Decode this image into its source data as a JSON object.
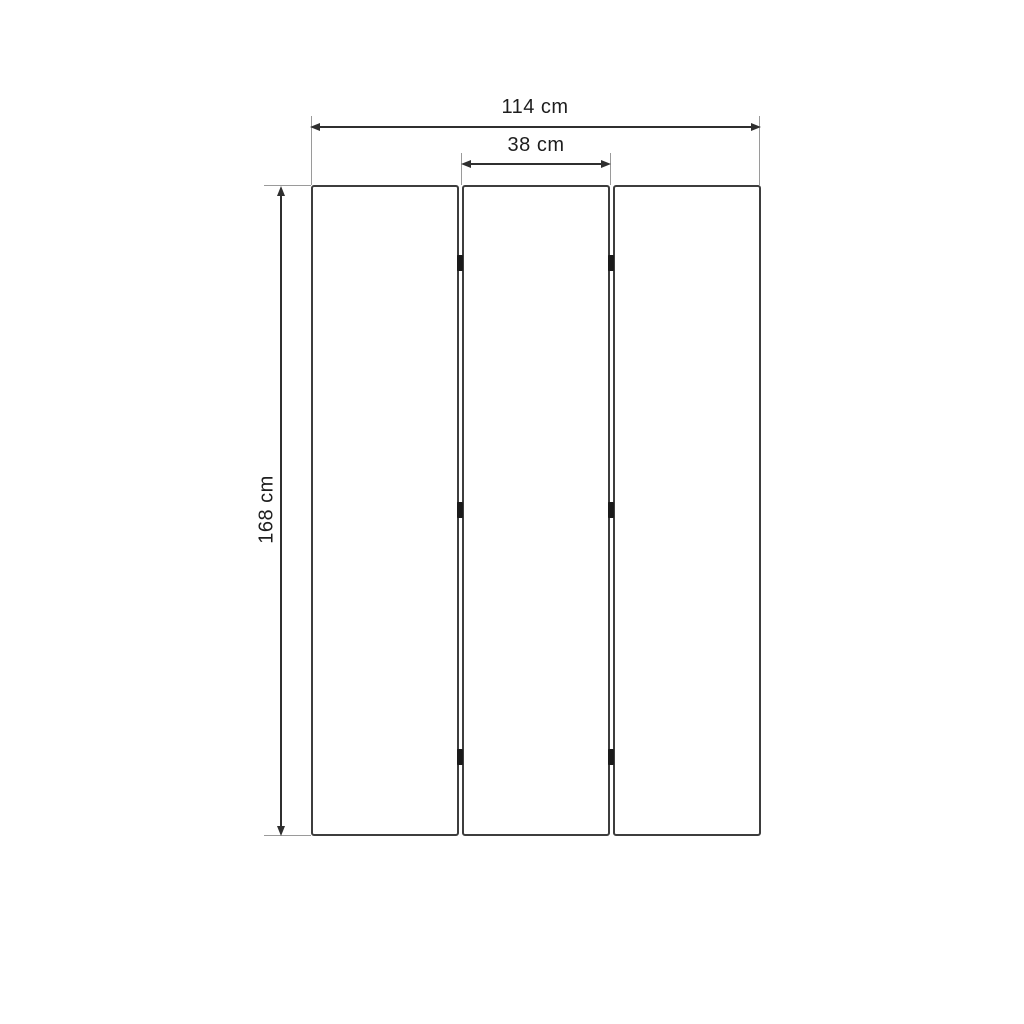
{
  "diagram": {
    "type": "technical-dimension-drawing",
    "panels": [
      {
        "id": "panel-left"
      },
      {
        "id": "panel-center"
      },
      {
        "id": "panel-right"
      }
    ],
    "hinge_count": 6,
    "dimensions": {
      "overall_width": {
        "value": 114,
        "unit": "cm",
        "label": "114 cm"
      },
      "panel_width": {
        "value": 38,
        "unit": "cm",
        "label": "38 cm"
      },
      "height": {
        "value": 168,
        "unit": "cm",
        "label": "168 cm"
      }
    },
    "colors": {
      "panel_border": "#3d3d3d",
      "dimension_line": "#2f2f2f",
      "extension_line": "#9a9a9a",
      "label_text": "#1e1e1e",
      "hinge": "#1a1a1a",
      "background": "#ffffff"
    }
  }
}
